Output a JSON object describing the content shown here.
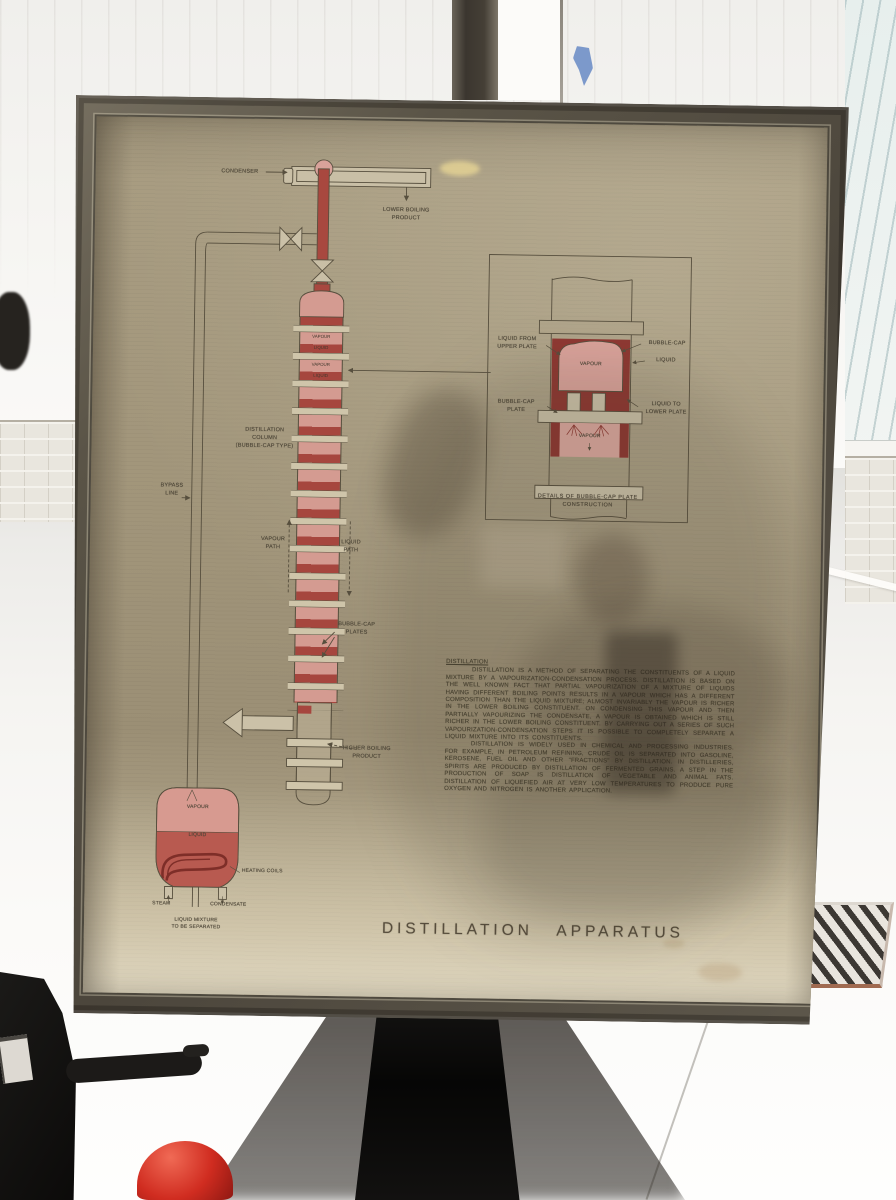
{
  "poster": {
    "title": "DISTILLATION  APPARATUS",
    "diagram": {
      "condenser": "CONDENSER",
      "lower_boiling_product": "LOWER BOILING\nPRODUCT",
      "bypass_line": "BYPASS\nLINE",
      "distillation_column": "DISTILLATION\nCOLUMN\n(BUBBLE-CAP TYPE)",
      "vapour_path": "VAPOUR\nPATH",
      "liquid_path": "LIQUID\nPATH",
      "bubble_cap_plates": "BUBBLE-CAP\nPLATES",
      "higher_boiling_product": "HIGHER BOILING\nPRODUCT",
      "column_bands": [
        "VAPOUR",
        "LIQUID",
        "VAPOUR",
        "LIQUID"
      ],
      "flask_vapour": "VAPOUR",
      "flask_liquid": "LIQUID",
      "heating_coils": "HEATING COILS",
      "steam": "STEAM",
      "condensate": "CONDENSATE",
      "liquid_mixture": "LIQUID MIXTURE\nTO BE SEPARATED"
    },
    "inset": {
      "liquid_from_upper_plate": "LIQUID FROM\nUPPER PLATE",
      "bubble_cap": "BUBBLE-CAP",
      "liquid": "LIQUID",
      "bubble_cap_plate": "BUBBLE-CAP\nPLATE",
      "liquid_to_lower_plate": "LIQUID TO\nLOWER PLATE",
      "vapour_top": "VAPOUR",
      "vapour_bottom": "VAPOUR",
      "caption": "DETAILS OF BUBBLE-CAP PLATE\nCONSTRUCTION"
    },
    "text_block": {
      "heading": "DISTILLATION",
      "paragraph1": "DISTILLATION IS A METHOD OF SEPARATING THE CONSTITUENTS OF A LIQUID MIXTURE BY A VAPOURIZATION-CONDENSATION PROCESS. DISTILLATION IS BASED ON THE WELL KNOWN FACT THAT PARTIAL VAPOURIZATION OF A MIXTURE OF LIQUIDS HAVING DIFFERENT BOILING POINTS RESULTS IN A VAPOUR WHICH HAS A DIFFERENT COMPOSITION THAN THE LIQUID MIXTURE; ALMOST INVARIABLY THE VAPOUR IS RICHER IN THE LOWER BOILING CONSTITUENT. ON CONDENSING THIS VAPOUR AND THEN PARTIALLY VAPOURIZING THE CONDENSATE, A VAPOUR IS OBTAINED WHICH IS STILL RICHER IN THE LOWER BOILING CONSTITUENT. BY CARRYING OUT A SERIES OF SUCH VAPOURIZATION-CONDENSATION STEPS IT IS POSSIBLE TO COMPLETELY SEPARATE A LIQUID MIXTURE INTO ITS CONSTITUENTS.",
      "paragraph2": "DISTILLATION IS WIDELY USED IN CHEMICAL AND PROCESSING INDUSTRIES. FOR EXAMPLE, IN PETROLEUM REFINING, CRUDE OIL IS SEPARATED INTO GASOLINE, KEROSENE, FUEL OIL AND OTHER \"FRACTIONS\" BY DISTILLATION. IN DISTILLERIES, SPIRITS ARE PRODUCED BY DISTILLATION OF FERMENTED GRAINS. A STEP IN THE PRODUCTION OF SOAP IS DISTILLATION OF VEGETABLE AND ANIMAL FATS. DISTILLATION OF LIQUEFIED AIR AT VERY LOW TEMPERATURES TO PRODUCE PURE OXYGEN AND NITROGEN IS ANOTHER APPLICATION."
    },
    "colors": {
      "paper": "#a2967c",
      "frame_wood": "#4c463c",
      "column_red": "#a6463e",
      "column_pink": "#d49b91",
      "flask_red": "#b85a50",
      "flask_pink": "#d79a90",
      "line_ink": "#574f3e",
      "cup_red": "#d02c20"
    }
  }
}
